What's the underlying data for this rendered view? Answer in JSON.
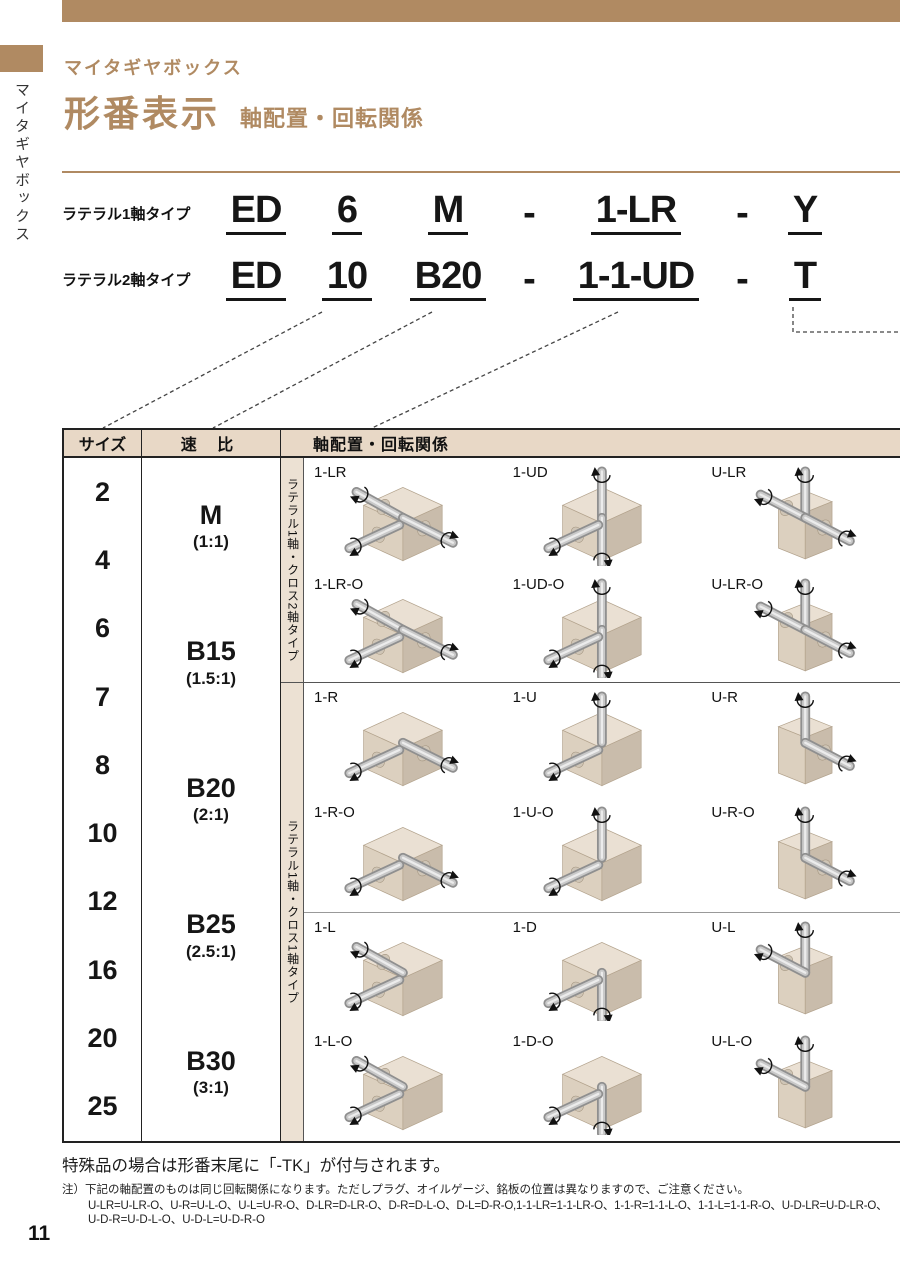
{
  "colors": {
    "accent_brown": "#b08a62",
    "table_header_bg": "#e8d8c6",
    "strip_bg": "#ece1d3",
    "text_dark": "#161616"
  },
  "sidebar": {
    "tab_label": "マイタギヤボックス"
  },
  "header": {
    "category": "マイタギヤボックス",
    "title": "形番表示",
    "subtitle": "軸配置・回転関係"
  },
  "model_rows": [
    {
      "label": "ラテラル1軸タイプ",
      "segments": [
        "ED",
        "6",
        "M",
        "-",
        "1-LR",
        "-",
        "Y"
      ]
    },
    {
      "label": "ラテラル2軸タイプ",
      "segments": [
        "ED",
        "10",
        "B20",
        "-",
        "1-1-UD",
        "-",
        "T"
      ]
    }
  ],
  "table": {
    "header": {
      "size": "サイズ",
      "ratio": "速 比",
      "arrangement": "軸配置・回転関係"
    },
    "sizes": [
      "2",
      "4",
      "6",
      "7",
      "8",
      "10",
      "12",
      "16",
      "20",
      "25"
    ],
    "ratios": [
      {
        "code": "M",
        "value": "(1:1)"
      },
      {
        "code": "B15",
        "value": "(1.5:1)"
      },
      {
        "code": "B20",
        "value": "(2:1)"
      },
      {
        "code": "B25",
        "value": "(2.5:1)"
      },
      {
        "code": "B30",
        "value": "(3:1)"
      }
    ],
    "sections": [
      {
        "strip_label": "ラテラル1軸・クロス2軸タイプ",
        "groups": [
          [
            [
              {
                "label": "1-LR",
                "box": "h",
                "shafts": [
                  "l",
                  "r",
                  "in"
                ]
              },
              {
                "label": "1-UD",
                "box": "v",
                "shafts": [
                  "u",
                  "d",
                  "in"
                ]
              },
              {
                "label": "U-LR",
                "box": "t",
                "shafts": [
                  "u",
                  "l",
                  "r"
                ]
              }
            ],
            [
              {
                "label": "1-LR-O",
                "box": "h",
                "shafts": [
                  "l",
                  "r",
                  "in"
                ]
              },
              {
                "label": "1-UD-O",
                "box": "v",
                "shafts": [
                  "u",
                  "d",
                  "in"
                ]
              },
              {
                "label": "U-LR-O",
                "box": "t",
                "shafts": [
                  "u",
                  "l",
                  "r"
                ]
              }
            ]
          ]
        ]
      },
      {
        "strip_label": "ラテラル1軸・クロス1軸タイプ",
        "groups": [
          [
            [
              {
                "label": "1-R",
                "box": "h",
                "shafts": [
                  "r",
                  "in"
                ]
              },
              {
                "label": "1-U",
                "box": "v",
                "shafts": [
                  "u",
                  "in"
                ]
              },
              {
                "label": "U-R",
                "box": "t",
                "shafts": [
                  "u",
                  "r"
                ]
              }
            ],
            [
              {
                "label": "1-R-O",
                "box": "h",
                "shafts": [
                  "r",
                  "in"
                ]
              },
              {
                "label": "1-U-O",
                "box": "v",
                "shafts": [
                  "u",
                  "in"
                ]
              },
              {
                "label": "U-R-O",
                "box": "t",
                "shafts": [
                  "u",
                  "r"
                ]
              }
            ]
          ],
          [
            [
              {
                "label": "1-L",
                "box": "h",
                "shafts": [
                  "l",
                  "in"
                ]
              },
              {
                "label": "1-D",
                "box": "v",
                "shafts": [
                  "d",
                  "in"
                ]
              },
              {
                "label": "U-L",
                "box": "t",
                "shafts": [
                  "u",
                  "l"
                ]
              }
            ],
            [
              {
                "label": "1-L-O",
                "box": "h",
                "shafts": [
                  "l",
                  "in"
                ]
              },
              {
                "label": "1-D-O",
                "box": "v",
                "shafts": [
                  "d",
                  "in"
                ]
              },
              {
                "label": "U-L-O",
                "box": "t",
                "shafts": [
                  "u",
                  "l"
                ]
              }
            ]
          ]
        ]
      }
    ]
  },
  "notes": {
    "special": "特殊品の場合は形番末尾に「-TK」が付与されます。",
    "note_head": "注）下記の軸配置のものは同じ回転関係になります。ただしプラグ、オイルゲージ、銘板の位置は異なりますので、ご注意ください。",
    "note_line1": "U-LR=U-LR-O、U-R=U-L-O、U-L=U-R-O、D-LR=D-LR-O、D-R=D-L-O、D-L=D-R-O,1-1-LR=1-1-LR-O、1-1-R=1-1-L-O、1-1-L=1-1-R-O、U-D-LR=U-D-LR-O、",
    "note_line2": "U-D-R=U-D-L-O、U-D-L=U-D-R-O"
  },
  "page_number": "11"
}
